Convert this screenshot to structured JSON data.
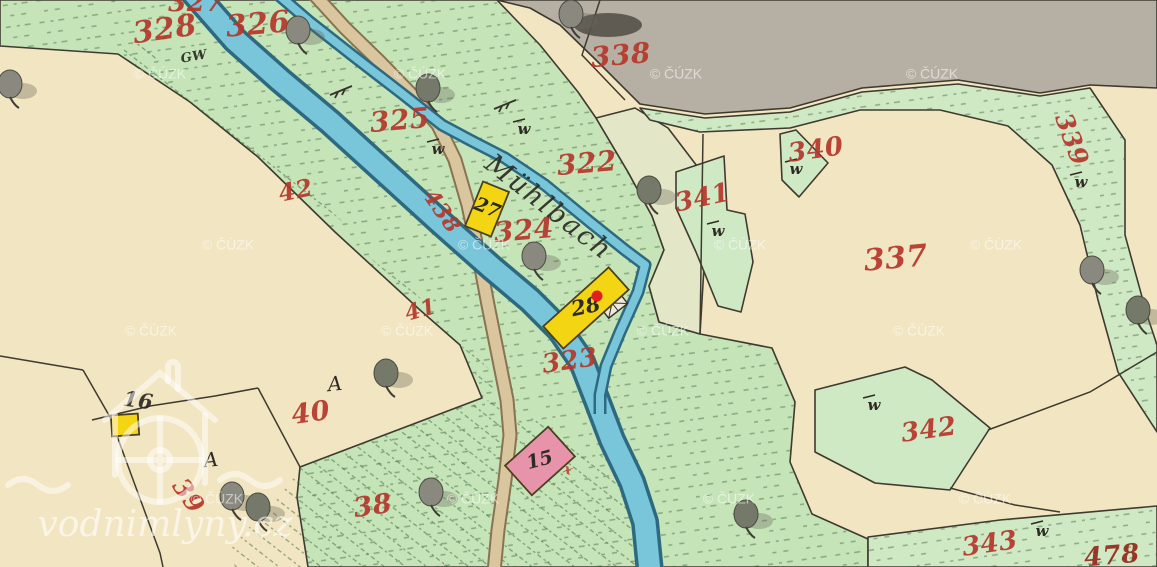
{
  "map": {
    "width": 1157,
    "height": 567,
    "colors": {
      "cream": "#f2e5c1",
      "green": "#c5e4b8",
      "green2": "#cfe9c4",
      "pale": "#e4e7c7",
      "gray": "#b6b0a4",
      "water": "#79c5da",
      "watercase": "#2d6a80",
      "road": "#d9c59e",
      "roadcase": "#8a7350",
      "ink": "#3f3a30",
      "red": "#b5372b",
      "red2": "#c44536",
      "darkred": "#932a1c",
      "black": "#2c2a24",
      "yellow": "#f4d514",
      "pink": "#e794aa",
      "dot": "#e02020"
    },
    "regions": [
      {
        "name": "parcel-region-stream-corridor",
        "fill": "green",
        "tufts": true,
        "points": "0,0 497,0 540,45 578,92 596,118 628,172 652,216 664,250 649,286 659,322 700,334 772,348 795,402 790,462 812,514 868,539 868,567 308,567 297,497 300,467 482,398 460,345 420,310 335,232 258,157 190,102 118,54 0,46"
      },
      {
        "name": "parcel-region-338-gray",
        "fill": "gray",
        "tufts": false,
        "points": "497,0 1157,0 1157,88 1090,85 1040,93 958,80 862,88 790,108 705,114 640,104 596,60 560,25 530,8"
      },
      {
        "name": "parcel-region-322-pale",
        "fill": "pale",
        "tufts": false,
        "points": "596,118 635,108 668,128 700,170 705,250 700,334 659,322 649,286 664,250 652,216 628,172"
      },
      {
        "name": "parcel-region-339-strip",
        "fill": "green2",
        "tufts": true,
        "points": "640,108 705,118 790,112 862,92 958,84 1040,96 1090,88 1125,140 1125,235 1147,315 1157,345 1157,432 1118,372 1098,300 1080,225 1052,165 1008,126 940,110 860,110 790,128 700,132 650,120"
      },
      {
        "name": "parcel-region-341",
        "fill": "green2",
        "tufts": false,
        "points": "676,172 724,156 727,210 745,214 753,262 741,312 718,306 696,252 676,208"
      },
      {
        "name": "parcel-region-340",
        "fill": "green2",
        "tufts": false,
        "points": "780,134 796,130 828,163 799,197 782,180"
      },
      {
        "name": "parcel-region-342",
        "fill": "green2",
        "tufts": false,
        "points": "815,390 905,367 932,380 990,428 950,490 875,483 815,452"
      },
      {
        "name": "parcel-region-343",
        "fill": "green2",
        "tufts": true,
        "points": "868,537 1000,520 1157,506 1157,567 868,567"
      }
    ],
    "hatches": [
      {
        "name": "hatch-parcel-38",
        "points": "230,550 300,467 482,398 560,430 640,480 650,567 235,567"
      },
      {
        "name": "hatch-strip-42-41",
        "points": "118,54 200,110 300,195 400,285 470,355 482,398 500,380 450,330 380,255 280,165 180,85 140,40"
      }
    ],
    "boundaries": [
      "83,370 110,417 160,553 163,567",
      "0,356 83,370",
      "92,420 150,406 215,396 258,388",
      "258,388 300,467",
      "988,430 1090,392 1157,352",
      "950,488 1015,505 1060,512",
      "600,0 582,55 625,100",
      "703,134 700,334"
    ],
    "streams": [
      {
        "name": "stream-main",
        "path": "M193,-8 L235,40 L280,80 L330,122 L385,172 L440,222 L492,268 L530,300 L560,330 L582,362 L596,398 L612,440 L632,482 L645,522 L650,572",
        "case_w": 28,
        "fill_w": 21
      },
      {
        "name": "stream-mill-race",
        "path": "M275,-8 L310,22 L352,55 L400,92 L442,125 L470,140 L505,158 L545,185 L590,222 L625,250 L645,265 L638,292 L620,332 L606,366 L600,395 L600,414",
        "case_w": 13,
        "fill_w": 8
      }
    ],
    "roads": [
      {
        "name": "road-path",
        "path": "M312,-8 L345,28 L380,62 L412,95 L438,125 L455,160 L468,205 L478,252 L488,305 L498,355 L507,400 L510,435 L505,480 L498,530 L494,572",
        "case_w": 15,
        "fill_w": 11
      }
    ],
    "bridge": {
      "cx": 612,
      "cy": 303,
      "w": 24,
      "h": 20,
      "rot": -38
    },
    "mill_marker": {
      "x": 597,
      "y": 296,
      "r": 5.5
    },
    "buildings": [
      {
        "name": "building-16",
        "cx": 125,
        "cy": 425,
        "w": 27,
        "h": 21,
        "rot": -4,
        "fill": "yellow",
        "label": ""
      },
      {
        "name": "building-27",
        "cx": 487,
        "cy": 209,
        "w": 28,
        "h": 48,
        "rot": 22,
        "fill": "yellow",
        "label": "27",
        "ls": 19,
        "lr": 22,
        "lc": "black"
      },
      {
        "name": "building-28",
        "cx": 586,
        "cy": 308,
        "w": 88,
        "h": 30,
        "rot": -42,
        "fill": "yellow",
        "label": "28",
        "ls": 21,
        "lr": -12,
        "lc": "black"
      },
      {
        "name": "building-15",
        "cx": 540,
        "cy": 461,
        "w": 58,
        "h": 40,
        "rot": -42,
        "fill": "pink",
        "label": "15",
        "ls": 19,
        "lr": -15,
        "lc": "black"
      }
    ],
    "labels": [
      {
        "t": "327",
        "x": 196,
        "y": 4,
        "s": 26,
        "r": 0,
        "c": "red"
      },
      {
        "t": "328",
        "x": 165,
        "y": 31,
        "s": 30,
        "r": -8,
        "c": "red"
      },
      {
        "t": "326",
        "x": 258,
        "y": 26,
        "s": 30,
        "r": -5,
        "c": "red"
      },
      {
        "t": "325",
        "x": 400,
        "y": 122,
        "s": 28,
        "r": -5,
        "c": "red"
      },
      {
        "t": "322",
        "x": 587,
        "y": 165,
        "s": 28,
        "r": -5,
        "c": "red"
      },
      {
        "t": "324",
        "x": 524,
        "y": 232,
        "s": 28,
        "r": -5,
        "c": "red"
      },
      {
        "t": "438",
        "x": 441,
        "y": 212,
        "s": 22,
        "r": 55,
        "c": "red"
      },
      {
        "t": "323",
        "x": 570,
        "y": 362,
        "s": 26,
        "r": -8,
        "c": "red"
      },
      {
        "t": "42",
        "x": 296,
        "y": 192,
        "s": 24,
        "r": -12,
        "c": "red"
      },
      {
        "t": "41",
        "x": 421,
        "y": 311,
        "s": 22,
        "r": -15,
        "c": "red"
      },
      {
        "t": "40",
        "x": 311,
        "y": 414,
        "s": 27,
        "r": -8,
        "c": "red"
      },
      {
        "t": "38",
        "x": 373,
        "y": 507,
        "s": 27,
        "r": -8,
        "c": "red"
      },
      {
        "t": "39",
        "x": 187,
        "y": 497,
        "s": 25,
        "r": 55,
        "c": "red"
      },
      {
        "t": "338",
        "x": 621,
        "y": 57,
        "s": 28,
        "r": -5,
        "c": "red"
      },
      {
        "t": "340",
        "x": 816,
        "y": 151,
        "s": 26,
        "r": -8,
        "c": "red"
      },
      {
        "t": "341",
        "x": 703,
        "y": 199,
        "s": 26,
        "r": -12,
        "c": "red"
      },
      {
        "t": "337",
        "x": 896,
        "y": 260,
        "s": 30,
        "r": -5,
        "c": "red"
      },
      {
        "t": "339",
        "x": 1070,
        "y": 140,
        "s": 25,
        "r": 70,
        "c": "red"
      },
      {
        "t": "342",
        "x": 929,
        "y": 431,
        "s": 26,
        "r": -8,
        "c": "red"
      },
      {
        "t": "343",
        "x": 990,
        "y": 545,
        "s": 26,
        "r": -8,
        "c": "red"
      },
      {
        "t": "478",
        "x": 1112,
        "y": 557,
        "s": 26,
        "r": -5,
        "c": "darkred"
      },
      {
        "t": "16",
        "x": 138,
        "y": 402,
        "s": 21,
        "r": 8,
        "c": "black"
      },
      {
        "t": "GW",
        "x": 194,
        "y": 57,
        "s": 13,
        "r": -10,
        "c": "black"
      },
      {
        "t": "x",
        "x": 568,
        "y": 470,
        "s": 14,
        "r": 20,
        "c": "red2"
      },
      {
        "t": "Mühlbach",
        "x": 548,
        "y": 208,
        "s": 27,
        "r": 38,
        "c": "black",
        "script": true
      }
    ],
    "symbols": {
      "trees": [
        {
          "x": 298,
          "y": 30
        },
        {
          "x": 428,
          "y": 88
        },
        {
          "x": 571,
          "y": 14
        },
        {
          "x": 649,
          "y": 190
        },
        {
          "x": 534,
          "y": 256
        },
        {
          "x": 386,
          "y": 373
        },
        {
          "x": 232,
          "y": 496
        },
        {
          "x": 258,
          "y": 507
        },
        {
          "x": 431,
          "y": 492
        },
        {
          "x": 746,
          "y": 514
        },
        {
          "x": 1092,
          "y": 270
        },
        {
          "x": 1138,
          "y": 310
        },
        {
          "x": 10,
          "y": 84
        }
      ],
      "grove_blob": {
        "x": 608,
        "y": 25,
        "rx": 34,
        "ry": 12
      },
      "w_marks": [
        {
          "x": 438,
          "y": 150
        },
        {
          "x": 524,
          "y": 130
        },
        {
          "x": 796,
          "y": 170
        },
        {
          "x": 718,
          "y": 232
        },
        {
          "x": 1081,
          "y": 183
        },
        {
          "x": 874,
          "y": 406
        },
        {
          "x": 1042,
          "y": 532
        }
      ],
      "a_marks": [
        {
          "x": 335,
          "y": 385
        },
        {
          "x": 211,
          "y": 461
        }
      ],
      "branches": [
        {
          "x": 342,
          "y": 90
        },
        {
          "x": 506,
          "y": 104
        }
      ]
    },
    "watermark": {
      "text": "© ČÚZK",
      "positions": [
        {
          "x": 160,
          "y": 75
        },
        {
          "x": 420,
          "y": 75
        },
        {
          "x": 676,
          "y": 75
        },
        {
          "x": 932,
          "y": 75
        },
        {
          "x": 228,
          "y": 246
        },
        {
          "x": 484,
          "y": 246
        },
        {
          "x": 740,
          "y": 246
        },
        {
          "x": 996,
          "y": 246
        },
        {
          "x": 151,
          "y": 332
        },
        {
          "x": 407,
          "y": 332
        },
        {
          "x": 663,
          "y": 332
        },
        {
          "x": 919,
          "y": 332
        },
        {
          "x": 217,
          "y": 500
        },
        {
          "x": 473,
          "y": 500
        },
        {
          "x": 729,
          "y": 500
        },
        {
          "x": 985,
          "y": 500
        }
      ]
    },
    "site_watermark": {
      "text": "vodnimlyny.cz",
      "x": 165,
      "y": 527,
      "s": 36
    },
    "logo": {
      "x": 160,
      "y": 455,
      "wheel_r": 42,
      "hub_r": 10
    }
  }
}
